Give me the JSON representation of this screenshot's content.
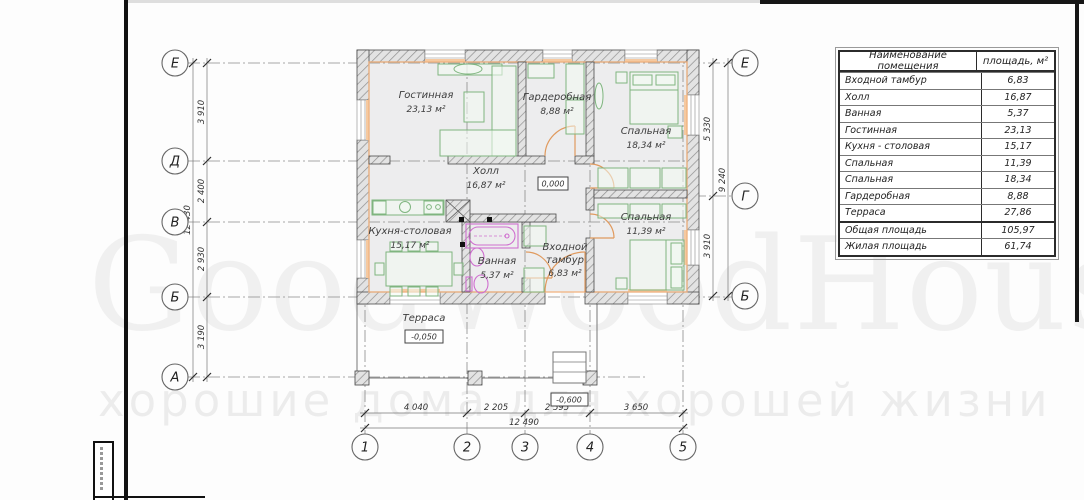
{
  "watermark": {
    "brand": "GoodWoodHouse",
    "tm": "™",
    "slogan": "хорошие дома для хорошей жизни"
  },
  "table": {
    "col_name": "Наименование помещения",
    "col_area": "площадь, м²",
    "rows": [
      {
        "name": "Входной тамбур",
        "area": "6,83"
      },
      {
        "name": "Холл",
        "area": "16,87"
      },
      {
        "name": "Ванная",
        "area": "5,37"
      },
      {
        "name": "Гостинная",
        "area": "23,13"
      },
      {
        "name": "Кухня - столовая",
        "area": "15,17"
      },
      {
        "name": "Спальная",
        "area": "11,39"
      },
      {
        "name": "Спальная",
        "area": "18,34"
      },
      {
        "name": "Гардеробная",
        "area": "8,88"
      },
      {
        "name": "Терраса",
        "area": "27,86"
      }
    ],
    "totals": [
      {
        "name": "Общая площадь",
        "area": "105,97"
      },
      {
        "name": "Жилая площадь",
        "area": "61,74"
      }
    ]
  },
  "plan": {
    "rooms": {
      "living": {
        "name": "Гостинная",
        "area": "23,13 м²"
      },
      "wardrobe": {
        "name": "Гардеробная",
        "area": "8,88 м²"
      },
      "bedroom1": {
        "name": "Спальная",
        "area": "18,34 м²"
      },
      "hall": {
        "name": "Холл",
        "area": "16,87 м²"
      },
      "kitchen": {
        "name": "Кухня-столовая",
        "area": "15,17 м²"
      },
      "bathroom": {
        "name": "Ванная",
        "area": "5,37 м²"
      },
      "vestibule": {
        "name": "Входной тамбур",
        "area": "6,83 м²"
      },
      "bedroom2": {
        "name": "Спальная",
        "area": "11,39 м²"
      },
      "terrace": {
        "name": "Терраса"
      }
    },
    "levels": {
      "zero": "0,000",
      "terrace": "-0,050",
      "porch": "-0,600"
    },
    "axes": {
      "left": [
        "Е",
        "Д",
        "В",
        "Б",
        "А"
      ],
      "right": [
        "Е",
        "Г",
        "Б"
      ],
      "bottom": [
        "1",
        "2",
        "3",
        "4",
        "5"
      ]
    },
    "dims": {
      "left": [
        "3 910",
        "2 400",
        "2 930",
        "3 190"
      ],
      "left_total": "12 430",
      "right": [
        "5 330",
        "3 910"
      ],
      "right_total": "9 240",
      "bottom": [
        "4 040",
        "2 205",
        "2 595",
        "3 650"
      ],
      "bottom_total": "12 490"
    },
    "colors": {
      "insulation_orange": "#f2b27e",
      "furniture_green": "#7fb57f",
      "plumbing_magenta": "#cf6fcf"
    }
  }
}
